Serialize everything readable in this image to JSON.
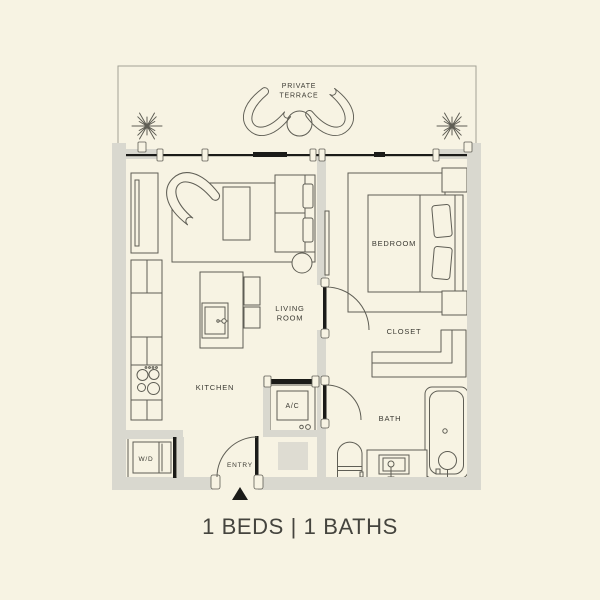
{
  "floor_plan": {
    "labels": {
      "terrace1": "PRIVATE",
      "terrace2": "TERRACE",
      "bedroom": "BEDROOM",
      "living1": "LIVING",
      "living2": "ROOM",
      "kitchen": "KITCHEN",
      "closet": "CLOSET",
      "bath": "BATH",
      "entry": "ENTRY",
      "ac": "A/C",
      "wd": "W/D"
    },
    "caption": "1 BEDS | 1 BATHS",
    "stats": {
      "beds": "1",
      "baths": "1"
    },
    "colors": {
      "background": "#f7f3e3",
      "wall": "#d9d8cf",
      "line": "#5f5e55",
      "dark": "#1b1b18",
      "text": "#3b3a33",
      "caption_text": "#45443e",
      "tile": "#dedcd2"
    }
  }
}
